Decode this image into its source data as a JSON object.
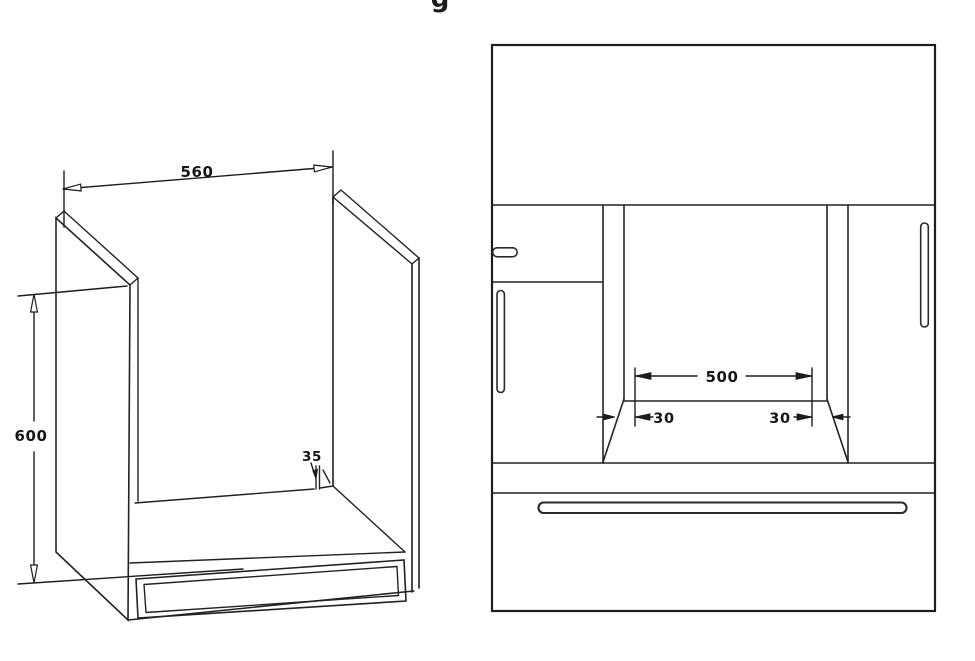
{
  "page": {
    "partial_title_glyph": "g"
  },
  "colors": {
    "line": "#222222",
    "text": "#161616",
    "background": "#ffffff"
  },
  "left_diagram": {
    "dim_width": "560",
    "dim_height": "600",
    "dim_back_ledge": "35"
  },
  "right_diagram": {
    "dim_niche_width": "500",
    "dim_clearance_left": "30",
    "dim_clearance_right": "30"
  }
}
